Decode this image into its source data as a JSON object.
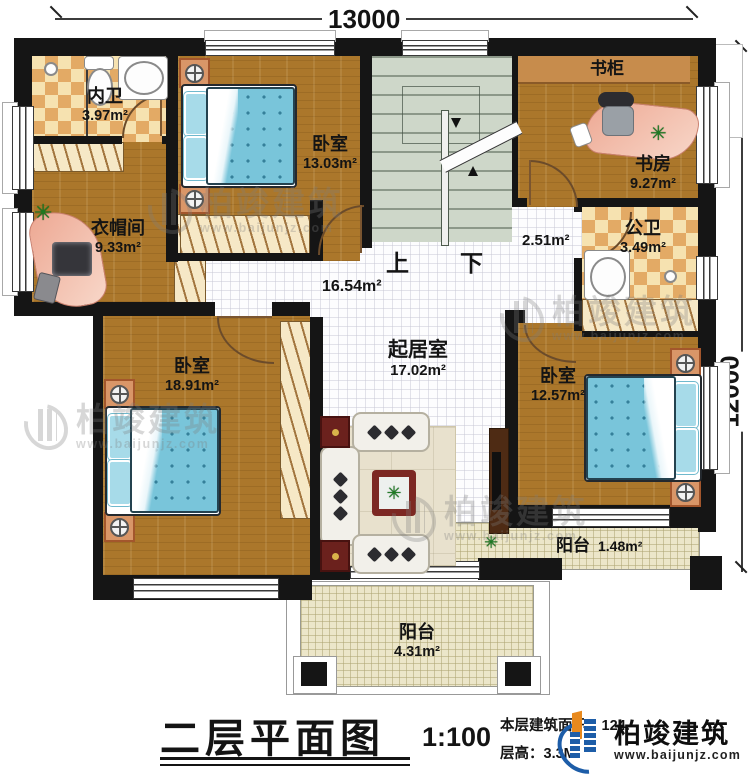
{
  "dimensions": {
    "top": "13000",
    "right": "12000"
  },
  "rooms": {
    "neiwei": {
      "name": "内卫",
      "area": "3.97m²"
    },
    "bedroom_top": {
      "name": "卧室",
      "area": "13.03m²"
    },
    "cloakroom": {
      "name": "衣帽间",
      "area": "9.33m²"
    },
    "bookcase": {
      "name": "书柜"
    },
    "study": {
      "name": "书房",
      "area": "9.27m²"
    },
    "gongwei": {
      "name": "公卫",
      "area": "3.49m²"
    },
    "corridor": {
      "area": "2.51m²"
    },
    "hall": {
      "area": "16.54m²"
    },
    "living": {
      "name": "起居室",
      "area": "17.02m²"
    },
    "bedroom_left": {
      "name": "卧室",
      "area": "18.91m²"
    },
    "bedroom_right": {
      "name": "卧室",
      "area": "12.57m²"
    },
    "balcony_right": {
      "name": "阳台",
      "area": "1.48m²"
    },
    "balcony_bottom": {
      "name": "阳台",
      "area": "4.31m²"
    }
  },
  "stairs": {
    "up": "上",
    "down": "下"
  },
  "titleblock": {
    "title": "二层平面图",
    "scale": "1:100",
    "area_line": "本层建筑面积：124.",
    "floor_height_line": "层高：3.3M"
  },
  "brand": {
    "name": "柏竣建筑",
    "url": "www.baijunjz.com"
  },
  "watermark": {
    "name": "柏竣建筑",
    "url": "www.baijunjz.com"
  },
  "icons": {
    "plant": "✳"
  }
}
